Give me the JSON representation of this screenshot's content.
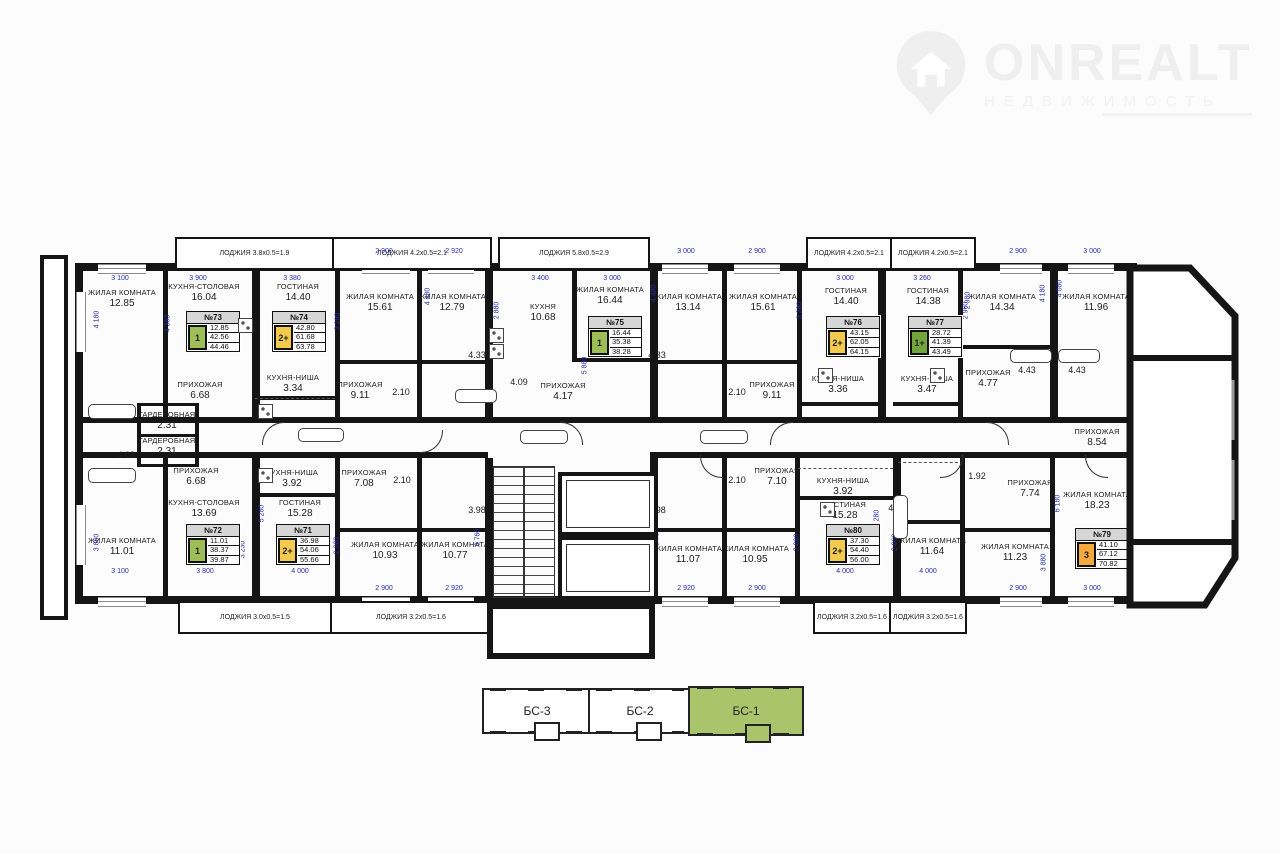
{
  "logo": {
    "brand": "ONREALT",
    "subtitle": "НЕДВИЖИМОСТЬ"
  },
  "colors": {
    "green": "#9dbd57",
    "dark_green": "#74a43c",
    "yellow": "#f3c94e",
    "orange": "#f3a93c",
    "header_gray": "#d6d6d6",
    "dim_blue": "#2929ae",
    "section_green": "#a9c46a"
  },
  "apartments": [
    {
      "number": "№73",
      "rooms": "1",
      "color": "green",
      "values": [
        "12.85",
        "42.56",
        "44.46"
      ],
      "x": 186,
      "y": 311
    },
    {
      "number": "№74",
      "rooms": "2+",
      "color": "yellow",
      "values": [
        "42.80",
        "61.68",
        "63.78"
      ],
      "x": 272,
      "y": 311
    },
    {
      "number": "№75",
      "rooms": "1",
      "color": "green",
      "values": [
        "16.44",
        "35.38",
        "38.28"
      ],
      "x": 588,
      "y": 316
    },
    {
      "number": "№76",
      "rooms": "2+",
      "color": "yellow",
      "values": [
        "43.15",
        "62.05",
        "64.15"
      ],
      "x": 826,
      "y": 316
    },
    {
      "number": "№77",
      "rooms": "1+",
      "color": "dark_green",
      "values": [
        "28.72",
        "41.39",
        "43.49"
      ],
      "x": 908,
      "y": 316
    },
    {
      "number": "№78",
      "rooms": "1",
      "color": "green",
      "values": [
        "11.96",
        "42.81",
        "45.31"
      ],
      "x": 1152,
      "y": 384
    },
    {
      "number": "№72",
      "rooms": "1",
      "color": "green",
      "values": [
        "11.01",
        "38.37",
        "39.87"
      ],
      "x": 186,
      "y": 524
    },
    {
      "number": "№71",
      "rooms": "2+",
      "color": "yellow",
      "values": [
        "36.98",
        "54.06",
        "55.66"
      ],
      "x": 276,
      "y": 524
    },
    {
      "number": "№80",
      "rooms": "2+",
      "color": "yellow",
      "values": [
        "37.30",
        "54.40",
        "56.00"
      ],
      "x": 826,
      "y": 524
    },
    {
      "number": "№79",
      "rooms": "3",
      "color": "orange",
      "values": [
        "41.10",
        "67.12",
        "70.82"
      ],
      "x": 1075,
      "y": 528
    }
  ],
  "rooms": [
    {
      "n": "ЖИЛАЯ КОМНАТА",
      "a": "12.85",
      "x": 122,
      "y": 296
    },
    {
      "n": "КУХНЯ-СТОЛОВАЯ",
      "a": "16.04",
      "x": 204,
      "y": 290
    },
    {
      "n": "ГОСТИНАЯ",
      "a": "14.40",
      "x": 298,
      "y": 290
    },
    {
      "n": "ЖИЛАЯ КОМНАТА",
      "a": "15.61",
      "x": 380,
      "y": 300
    },
    {
      "n": "ЖИЛАЯ КОМНАТА",
      "a": "12.79",
      "x": 452,
      "y": 300
    },
    {
      "n": "КУХНЯ",
      "a": "10.68",
      "x": 543,
      "y": 310
    },
    {
      "n": "ЖИЛАЯ КОМНАТА",
      "a": "16.44",
      "x": 610,
      "y": 293
    },
    {
      "n": "ЖИЛАЯ КОМНАТА",
      "a": "13.14",
      "x": 688,
      "y": 300
    },
    {
      "n": "ЖИЛАЯ КОМНАТА",
      "a": "15.61",
      "x": 763,
      "y": 300
    },
    {
      "n": "ГОСТИНАЯ",
      "a": "14.40",
      "x": 846,
      "y": 294
    },
    {
      "n": "ГОСТИНАЯ",
      "a": "14.38",
      "x": 928,
      "y": 294
    },
    {
      "n": "ЖИЛАЯ КОМНАТА",
      "a": "14.34",
      "x": 1002,
      "y": 300
    },
    {
      "n": "ЖИЛАЯ КОМНАТА",
      "a": "11.96",
      "x": 1096,
      "y": 300
    },
    {
      "n": "КУХНЯ-ГОСТИНАЯ",
      "a": "17.88",
      "x": 1178,
      "y": 368
    },
    {
      "n": "ПРИХОЖАЯ",
      "a": "6.68",
      "x": 200,
      "y": 388
    },
    {
      "n": "ГАРДЕРОБНАЯ",
      "a": "2.31",
      "x": 167,
      "y": 418
    },
    {
      "n": "ГАРДЕРОБНАЯ",
      "a": "2.31",
      "x": 167,
      "y": 444
    },
    {
      "n": "",
      "a": "4.68",
      "x": 126,
      "y": 411
    },
    {
      "n": "",
      "a": "4.68",
      "x": 126,
      "y": 455
    },
    {
      "n": "КУХНЯ-НИША",
      "a": "3.34",
      "x": 293,
      "y": 381
    },
    {
      "n": "ПРИХОЖАЯ",
      "a": "9.11",
      "x": 360,
      "y": 388
    },
    {
      "n": "",
      "a": "2.10",
      "x": 401,
      "y": 392
    },
    {
      "n": "",
      "a": "4.33",
      "x": 477,
      "y": 355
    },
    {
      "n": "",
      "a": "4.09",
      "x": 519,
      "y": 382
    },
    {
      "n": "ПРИХОЖАЯ",
      "a": "4.17",
      "x": 563,
      "y": 389
    },
    {
      "n": "",
      "a": "4.33",
      "x": 657,
      "y": 355
    },
    {
      "n": "",
      "a": "2.10",
      "x": 737,
      "y": 392
    },
    {
      "n": "ПРИХОЖАЯ",
      "a": "9.11",
      "x": 772,
      "y": 388
    },
    {
      "n": "КУХНЯ-НИША",
      "a": "3.36",
      "x": 838,
      "y": 382
    },
    {
      "n": "КУХНЯ-НИША",
      "a": "3.47",
      "x": 927,
      "y": 382
    },
    {
      "n": "ПРИХОЖАЯ",
      "a": "4.77",
      "x": 988,
      "y": 376
    },
    {
      "n": "",
      "a": "4.43",
      "x": 1027,
      "y": 370
    },
    {
      "n": "",
      "a": "4.43",
      "x": 1077,
      "y": 370
    },
    {
      "n": "ПРИХОЖАЯ",
      "a": "8.54",
      "x": 1097,
      "y": 435
    },
    {
      "n": "ЖИЛАЯ КОМНАТА",
      "a": "11.01",
      "x": 122,
      "y": 544
    },
    {
      "n": "КУХНЯ-СТОЛОВАЯ",
      "a": "13.69",
      "x": 204,
      "y": 506
    },
    {
      "n": "ПРИХОЖАЯ",
      "a": "6.68",
      "x": 196,
      "y": 474
    },
    {
      "n": "КУХНЯ-НИША",
      "a": "3.92",
      "x": 292,
      "y": 476
    },
    {
      "n": "ГОСТИНАЯ",
      "a": "15.28",
      "x": 300,
      "y": 506
    },
    {
      "n": "ПРИХОЖАЯ",
      "a": "7.08",
      "x": 364,
      "y": 476
    },
    {
      "n": "",
      "a": "2.10",
      "x": 402,
      "y": 480
    },
    {
      "n": "",
      "a": "3.98",
      "x": 477,
      "y": 510
    },
    {
      "n": "ЖИЛАЯ КОМНАТА",
      "a": "10.93",
      "x": 385,
      "y": 548
    },
    {
      "n": "ЖИЛАЯ КОМНАТА",
      "a": "10.77",
      "x": 455,
      "y": 548
    },
    {
      "n": "",
      "a": "3.98",
      "x": 657,
      "y": 510
    },
    {
      "n": "ЖИЛАЯ КОМНАТА",
      "a": "11.07",
      "x": 688,
      "y": 552
    },
    {
      "n": "ЖИЛАЯ КОМНАТА",
      "a": "10.95",
      "x": 755,
      "y": 552
    },
    {
      "n": "",
      "a": "2.10",
      "x": 737,
      "y": 480
    },
    {
      "n": "ПРИХОЖАЯ",
      "a": "7.10",
      "x": 777,
      "y": 474
    },
    {
      "n": "КУХНЯ-НИША",
      "a": "3.92",
      "x": 843,
      "y": 484
    },
    {
      "n": "ГОСТИНАЯ",
      "a": "15.28",
      "x": 845,
      "y": 508
    },
    {
      "n": "",
      "a": "4.13",
      "x": 897,
      "y": 508
    },
    {
      "n": "ЖИЛАЯ КОМНАТА",
      "a": "11.64",
      "x": 932,
      "y": 544
    },
    {
      "n": "",
      "a": "1.92",
      "x": 977,
      "y": 476
    },
    {
      "n": "ПРИХОЖАЯ",
      "a": "7.74",
      "x": 1030,
      "y": 486
    },
    {
      "n": "ЖИЛАЯ КОМНАТА",
      "a": "11.23",
      "x": 1015,
      "y": 550
    },
    {
      "n": "ЖИЛАЯ КОМНАТА",
      "a": "18.23",
      "x": 1097,
      "y": 498
    },
    {
      "n": "КУХНЯ",
      "a": "12.23",
      "x": 1177,
      "y": 504
    }
  ],
  "loggias": [
    {
      "t": "ЛОДЖИЯ 3.8х0.5=1.9",
      "x": 175,
      "y": 237,
      "w": 155,
      "h": 29
    },
    {
      "t": "ЛОДЖИЯ 4.2х0.5=2.1",
      "x": 332,
      "y": 237,
      "w": 156,
      "h": 29
    },
    {
      "t": "ЛОДЖИЯ 5.8х0.5=2.9",
      "x": 498,
      "y": 237,
      "w": 148,
      "h": 29
    },
    {
      "t": "ЛОДЖИЯ 4.2х0.5=2.1",
      "x": 806,
      "y": 237,
      "w": 82,
      "h": 29
    },
    {
      "t": "ЛОДЖИЯ 4.2х0.5=2.1",
      "x": 890,
      "y": 237,
      "w": 82,
      "h": 29
    },
    {
      "t": "ЛОДЖИЯ 3.0х0.5=1.5",
      "x": 178,
      "y": 601,
      "w": 150,
      "h": 29
    },
    {
      "t": "ЛОДЖИЯ 3.2х0.5=1.6",
      "x": 330,
      "y": 601,
      "w": 158,
      "h": 29
    },
    {
      "t": "ЛОДЖИЯ 3.2х0.5=1.6",
      "x": 813,
      "y": 601,
      "w": 74,
      "h": 29
    },
    {
      "t": "ЛОДЖИЯ 3.2х0.5=1.6",
      "x": 889,
      "y": 601,
      "w": 74,
      "h": 29
    },
    {
      "t": "ЛОДЖИЯ 5.0х0.5=2.5",
      "x": 1122,
      "y": 298,
      "w": 0,
      "h": 0
    },
    {
      "t": "ЛОДЖИЯ 4.2х0.5=2.1",
      "x": 1118,
      "y": 566,
      "w": 0,
      "h": 0
    }
  ],
  "dims": [
    {
      "t": "3 100",
      "x": 120,
      "y": 279
    },
    {
      "t": "3 900",
      "x": 198,
      "y": 279
    },
    {
      "t": "3 380",
      "x": 292,
      "y": 279
    },
    {
      "t": "2 900",
      "x": 384,
      "y": 252
    },
    {
      "t": "2 920",
      "x": 454,
      "y": 252
    },
    {
      "t": "3 400",
      "x": 540,
      "y": 279
    },
    {
      "t": "3 000",
      "x": 612,
      "y": 279
    },
    {
      "t": "3 000",
      "x": 686,
      "y": 252
    },
    {
      "t": "2 900",
      "x": 757,
      "y": 252
    },
    {
      "t": "3 000",
      "x": 845,
      "y": 279
    },
    {
      "t": "3 260",
      "x": 922,
      "y": 279
    },
    {
      "t": "2 900",
      "x": 1018,
      "y": 252
    },
    {
      "t": "3 000",
      "x": 1092,
      "y": 252
    },
    {
      "t": "950",
      "x": 1160,
      "y": 354
    },
    {
      "t": "3 100",
      "x": 120,
      "y": 572
    },
    {
      "t": "3 800",
      "x": 205,
      "y": 572
    },
    {
      "t": "4 000",
      "x": 300,
      "y": 572
    },
    {
      "t": "2 900",
      "x": 384,
      "y": 589
    },
    {
      "t": "2 920",
      "x": 454,
      "y": 589
    },
    {
      "t": "2 920",
      "x": 686,
      "y": 589
    },
    {
      "t": "2 900",
      "x": 757,
      "y": 589
    },
    {
      "t": "4 000",
      "x": 845,
      "y": 572
    },
    {
      "t": "4 000",
      "x": 928,
      "y": 572
    },
    {
      "t": "2 900",
      "x": 1018,
      "y": 589
    },
    {
      "t": "3 000",
      "x": 1092,
      "y": 589
    },
    {
      "t": "3 900",
      "x": 1168,
      "y": 526
    },
    {
      "t": "2 600",
      "x": 1172,
      "y": 446
    },
    {
      "t": "2 600",
      "x": 1172,
      "y": 464
    },
    {
      "t": "4 180",
      "x": 97,
      "y": 320,
      "v": 1
    },
    {
      "t": "3 860",
      "x": 97,
      "y": 543,
      "v": 1
    },
    {
      "t": "4 380",
      "x": 168,
      "y": 324,
      "v": 1
    },
    {
      "t": "3 230",
      "x": 243,
      "y": 550,
      "v": 1
    },
    {
      "t": "5 880",
      "x": 280,
      "y": 330,
      "v": 1
    },
    {
      "t": "5 280",
      "x": 262,
      "y": 514,
      "v": 1
    },
    {
      "t": "3 280",
      "x": 338,
      "y": 322,
      "v": 1
    },
    {
      "t": "2 880",
      "x": 337,
      "y": 546,
      "v": 1
    },
    {
      "t": "4 480",
      "x": 428,
      "y": 297,
      "v": 1
    },
    {
      "t": "3 760",
      "x": 478,
      "y": 538,
      "v": 1
    },
    {
      "t": "2 880",
      "x": 497,
      "y": 311,
      "v": 1
    },
    {
      "t": "5 880",
      "x": 585,
      "y": 366,
      "v": 1
    },
    {
      "t": "3 760",
      "x": 657,
      "y": 538,
      "v": 1
    },
    {
      "t": "4 480",
      "x": 654,
      "y": 294,
      "v": 1
    },
    {
      "t": "3 280",
      "x": 800,
      "y": 311,
      "v": 1
    },
    {
      "t": "5 880",
      "x": 878,
      "y": 336,
      "v": 1
    },
    {
      "t": "5 280",
      "x": 877,
      "y": 519,
      "v": 1
    },
    {
      "t": "2 960",
      "x": 966,
      "y": 311,
      "v": 1
    },
    {
      "t": "2 880",
      "x": 797,
      "y": 543,
      "v": 1
    },
    {
      "t": "2 960",
      "x": 895,
      "y": 543,
      "v": 1
    },
    {
      "t": "2 980",
      "x": 968,
      "y": 301,
      "v": 1
    },
    {
      "t": "4 180",
      "x": 1043,
      "y": 294,
      "v": 1
    },
    {
      "t": "4 080",
      "x": 1060,
      "y": 289,
      "v": 1
    },
    {
      "t": "4 900",
      "x": 1207,
      "y": 399,
      "v": 1
    },
    {
      "t": "3 400",
      "x": 1203,
      "y": 494,
      "v": 1
    },
    {
      "t": "6 180",
      "x": 1058,
      "y": 504,
      "v": 1
    },
    {
      "t": "3 880",
      "x": 1044,
      "y": 563,
      "v": 1
    }
  ],
  "sections": [
    {
      "label": "БС-3",
      "x": 482,
      "y": 688,
      "w": 106,
      "h": 42,
      "active": false
    },
    {
      "label": "БС-2",
      "x": 588,
      "y": 688,
      "w": 100,
      "h": 42,
      "active": false
    },
    {
      "label": "БС-1",
      "x": 688,
      "y": 686,
      "w": 112,
      "h": 46,
      "active": true
    }
  ]
}
